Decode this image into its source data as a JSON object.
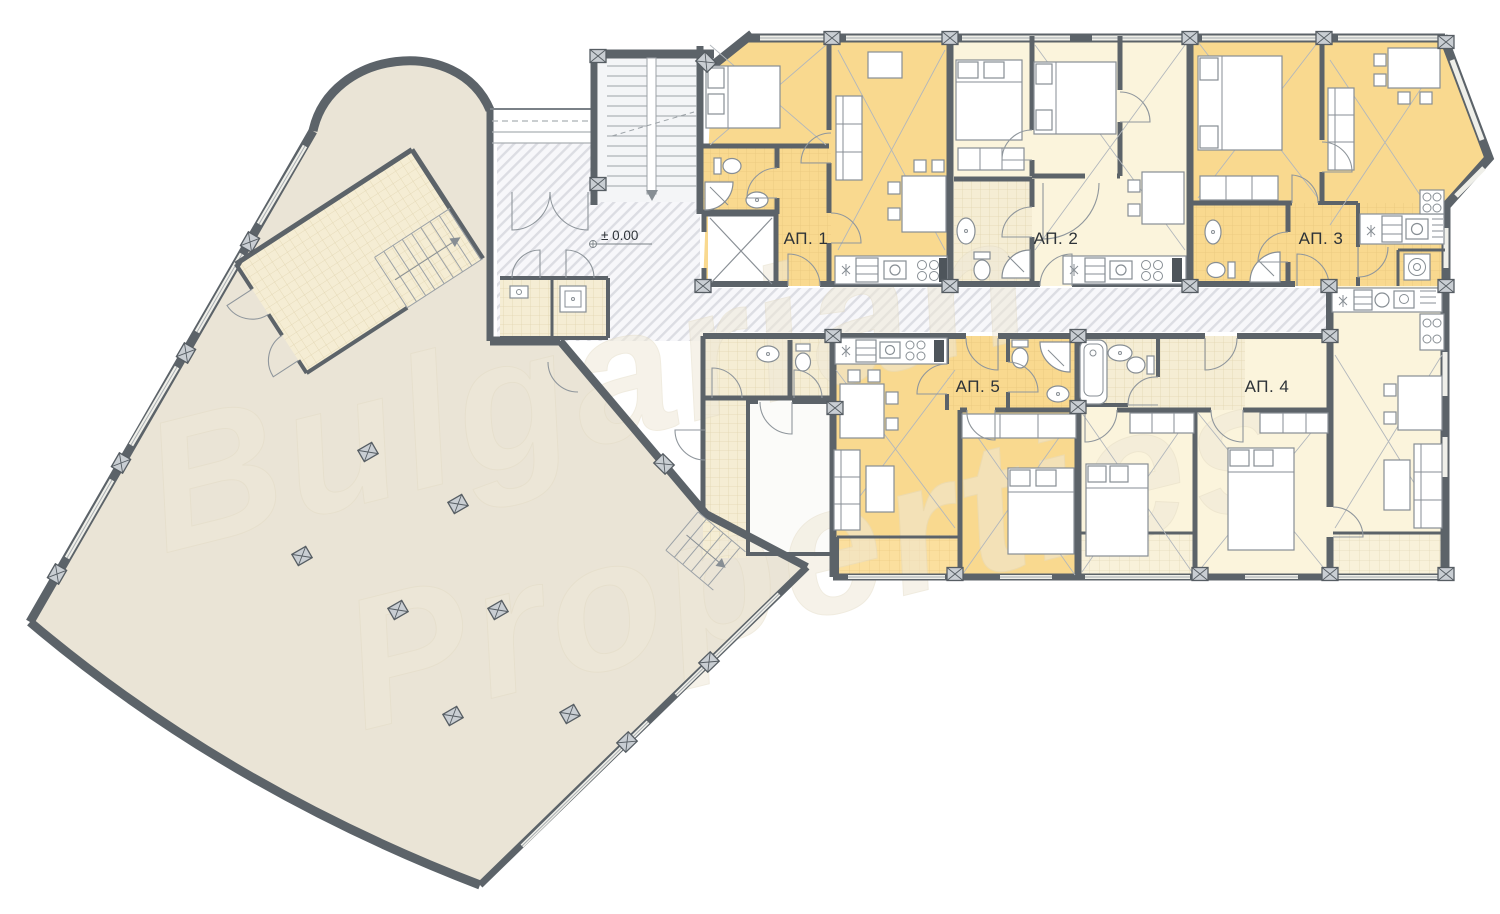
{
  "floor_plan": {
    "level_mark": "± 0.00",
    "apartments": [
      {
        "id": "ap1",
        "label": "АП. 1",
        "color": "#F9D98F"
      },
      {
        "id": "ap2",
        "label": "АП. 2",
        "color": "#FBF4DC"
      },
      {
        "id": "ap3",
        "label": "АП. 3",
        "color": "#F9D98F"
      },
      {
        "id": "ap4",
        "label": "АП. 4",
        "color": "#FBF4DC"
      },
      {
        "id": "ap5",
        "label": "АП. 5",
        "color": "#F9D98F"
      }
    ],
    "watermark": {
      "line1": "Bulgarian",
      "line2": "Properties"
    },
    "colors": {
      "walls": "#5C6369",
      "warm_apartment": "#F9D98F",
      "light_apartment": "#FBF4DC",
      "hall_floor": "#EAE4D6",
      "hatch_line": "#DCDDE3",
      "background": "#FFFFFF"
    }
  }
}
